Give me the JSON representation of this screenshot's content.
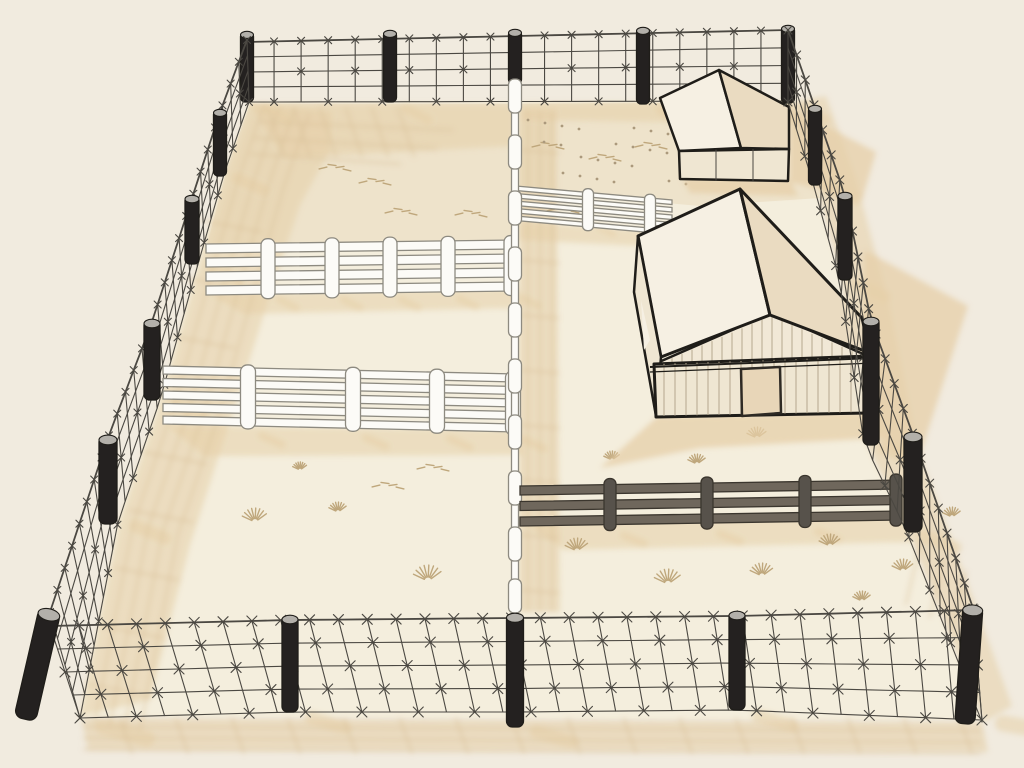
{
  "scene": {
    "title": "Isometric line-art illustration of a large fenced ranch enclosure: barbed-wire perimeter fence with black posts, white rail fences dividing four paddocks, a dark wooden rail fence, a gable-roof barn and a small hip-roof shed on cream ground",
    "background_color": "#f1ebdf",
    "palette": {
      "bg": "#f1ebdf",
      "interior": "#f4eedd",
      "paddock": "#eee3cb",
      "shadow": "#e5cfa8",
      "shadow_line": "#d9bf97",
      "ink": "#1f1d19",
      "wire": "#4b4842",
      "post": "#242120",
      "post_cap": "#b3b0aa",
      "white_rail": "#fcfbf7",
      "white_stroke": "#8d8a80",
      "dark_rail": "#6f675c",
      "dark_stroke": "#3b362e",
      "dark_post": "#57524b",
      "roof_light": "#f6f0e3",
      "roof_tan": "#eadbc1",
      "gable": "#f1e8d6",
      "wall": "#efe6d2",
      "wall_line": "#b5a78d",
      "door": "#e8d6b8",
      "door_stroke": "#2e2a24",
      "grass": "#bfa77c",
      "speckle": "#ab997c"
    },
    "objects": [
      {
        "name": "perimeter-fence",
        "type": "barbed-wire mesh fence",
        "sides": [
          "top",
          "left",
          "right",
          "bottom"
        ],
        "post_count": 17,
        "wires_per_side": 5
      },
      {
        "name": "center-divider-fence",
        "type": "white rail fence seen edge-on",
        "orientation": "vertical"
      },
      {
        "name": "upper-left-rail-fence",
        "type": "white rail fence",
        "rails": 4,
        "posts": 5
      },
      {
        "name": "lower-left-rail-fence",
        "type": "white rail fence",
        "rails": 5,
        "posts": 4
      },
      {
        "name": "right-rail-fence",
        "type": "white rail fence",
        "rails": 5,
        "posts": 2
      },
      {
        "name": "dark-rail-fence",
        "type": "dark wooden rail fence",
        "rails": 3,
        "posts": 4
      },
      {
        "name": "barn",
        "type": "gable-roof barn",
        "features": [
          "vertical siding",
          "front door",
          "gable hatching"
        ]
      },
      {
        "name": "shed",
        "type": "small hip-roof shed",
        "features": [
          "three front panels"
        ]
      },
      {
        "name": "paddocks",
        "count": 4,
        "ground": "dirt with grass tufts and speckles"
      }
    ]
  }
}
